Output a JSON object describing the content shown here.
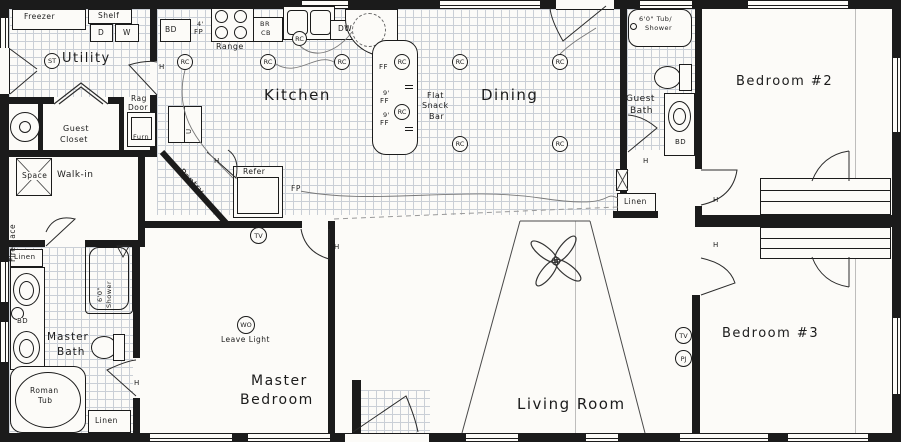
{
  "palette": {
    "ink": "#1b1b1b",
    "paper": "#fcfbf8",
    "tile_line": "#9aa4b5"
  },
  "t": {
    "utility": "Utility",
    "kitchen": "Kitchen",
    "dining": "Dining",
    "living_room": "Living Room",
    "master": "Master",
    "bedroom": "Bedroom",
    "bedroom2": "Bedroom #2",
    "bedroom3": "Bedroom #3",
    "bath": "Bath",
    "guest": "Guest",
    "closet": "Closet",
    "walk_in": "Walk-in",
    "pantry": "Pantry",
    "linen": "Linen",
    "freezer": "Freezer",
    "shelf": "Shelf",
    "space": "Space",
    "fireplace": "Fireplace",
    "rag": "Rag",
    "door": "Door",
    "furn": "Furn",
    "d": "D",
    "w": "W",
    "bd": "BD",
    "range": "Range",
    "br": "BR",
    "cb": "CB",
    "dw": "DW",
    "refer": "Refer",
    "fp": "FP",
    "ff": "FF",
    "u": "U",
    "four_ft": "4'",
    "nine_ft": "9'",
    "roman": "Roman",
    "tub": "Tub",
    "shower": "Shower",
    "six_shower": "6'0\"",
    "tub_shower": "6'0\" Tub/",
    "flat": "Flat",
    "snack": "Snack",
    "bar": "Bar",
    "st": "ST",
    "rc": "RC",
    "tv": "TV",
    "pj": "PJ",
    "wo": "WO",
    "leave_light": "Leave Light",
    "h": "H"
  }
}
